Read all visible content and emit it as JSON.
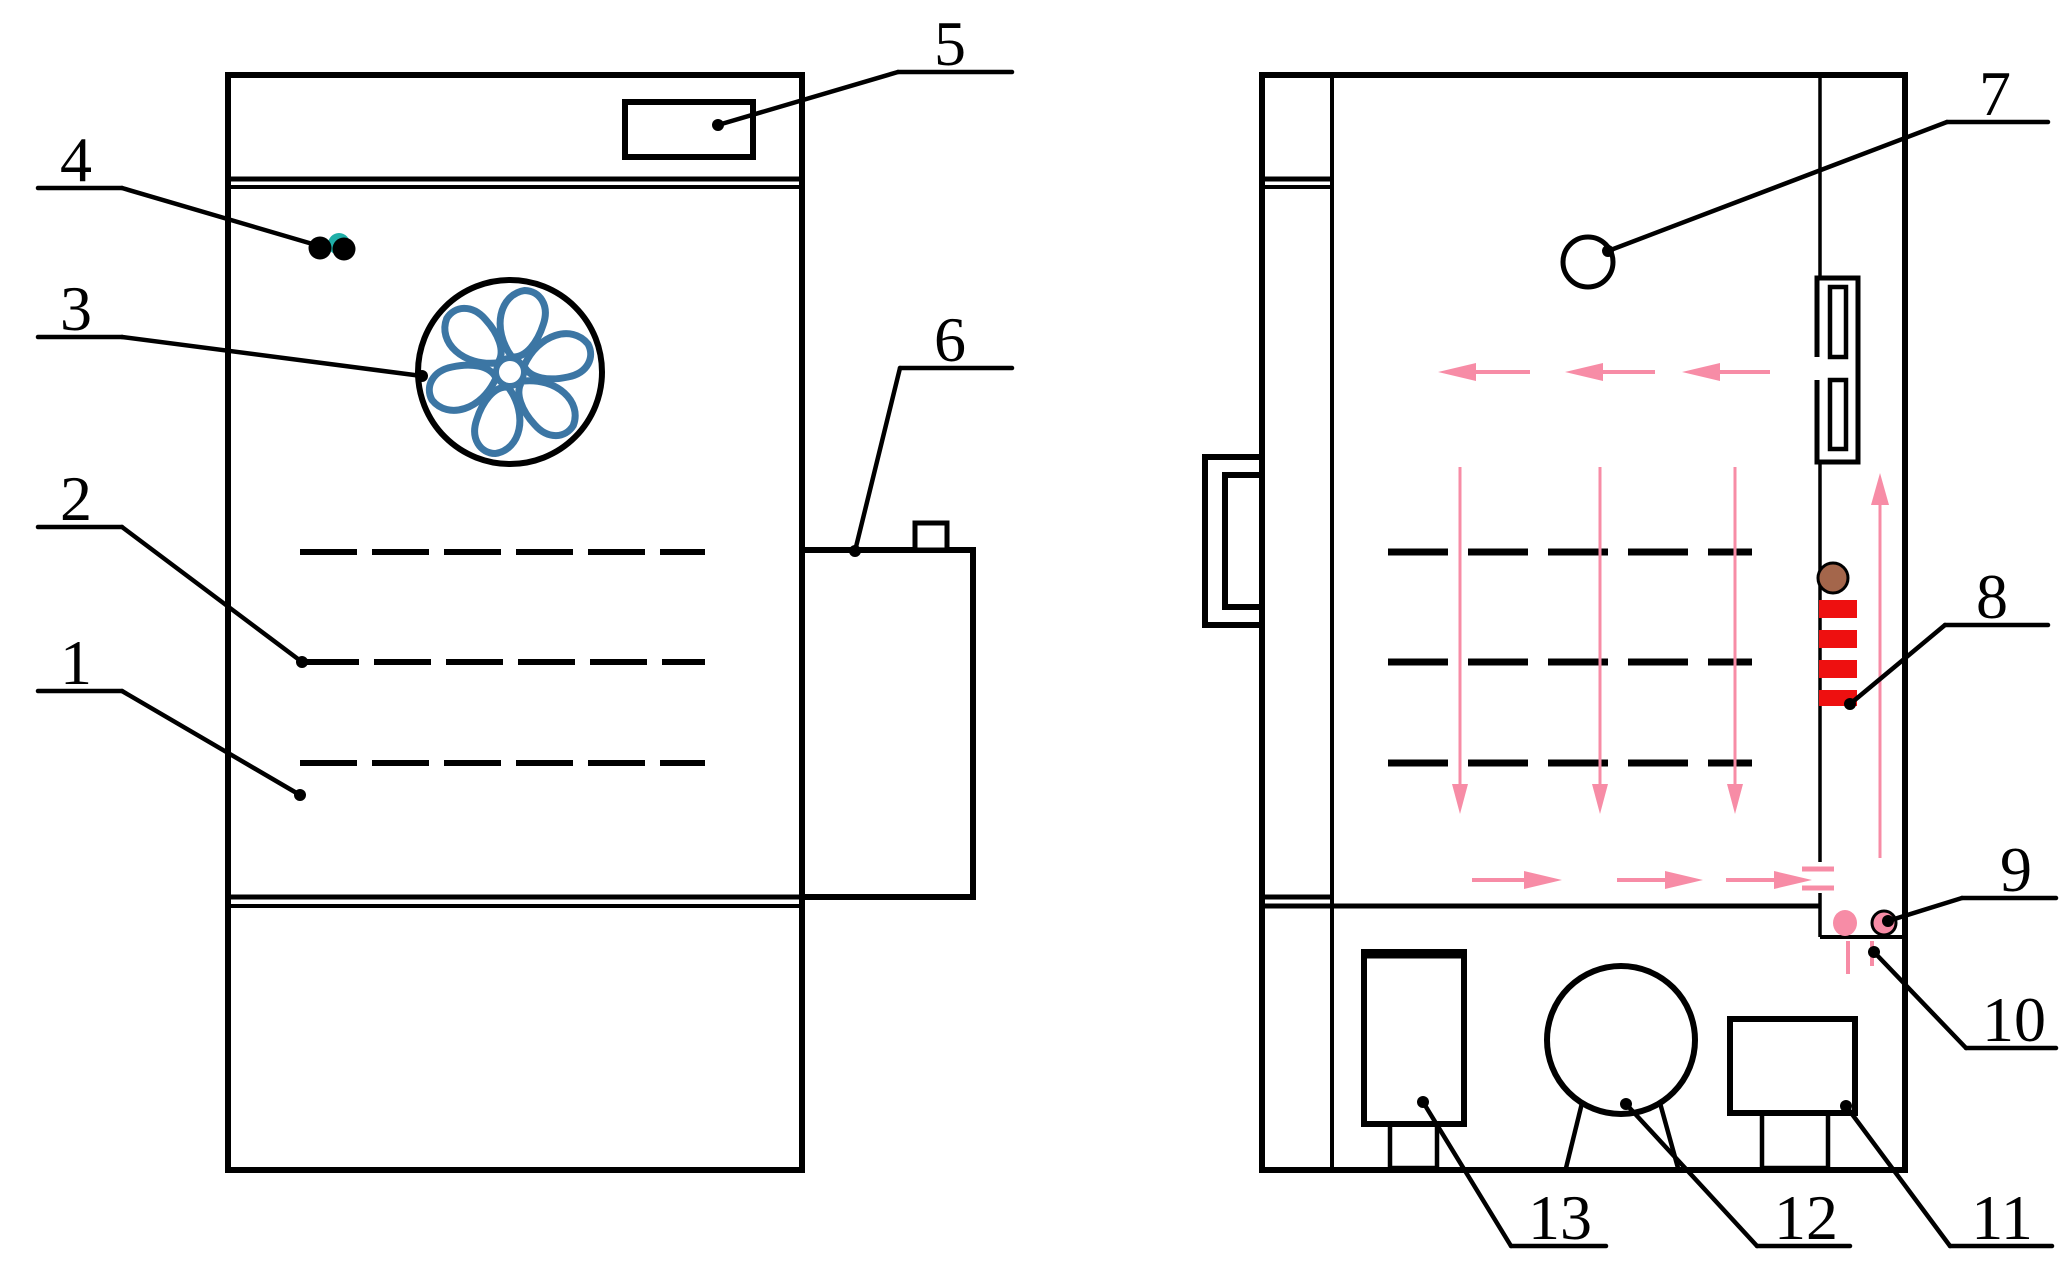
{
  "figure": {
    "kind": "patent-style technical line drawing",
    "subject": "incubator / test chamber cabinet",
    "views": [
      {
        "name": "front exterior view"
      },
      {
        "name": "side section view with airflow"
      }
    ]
  },
  "colors": {
    "line": "#000000",
    "background": "#ffffff",
    "fan_blue": "#3C76A4",
    "flow_pink": "#F78CA6",
    "heater_red": "#EE1010",
    "sensor_brown": "#A4664B",
    "indicator_teal": "#1FAFA8"
  },
  "callouts": [
    {
      "number": "1"
    },
    {
      "number": "2"
    },
    {
      "number": "3"
    },
    {
      "number": "4"
    },
    {
      "number": "5"
    },
    {
      "number": "6"
    },
    {
      "number": "7"
    },
    {
      "number": "8"
    },
    {
      "number": "9"
    },
    {
      "number": "10"
    },
    {
      "number": "11"
    },
    {
      "number": "12"
    },
    {
      "number": "13"
    }
  ]
}
